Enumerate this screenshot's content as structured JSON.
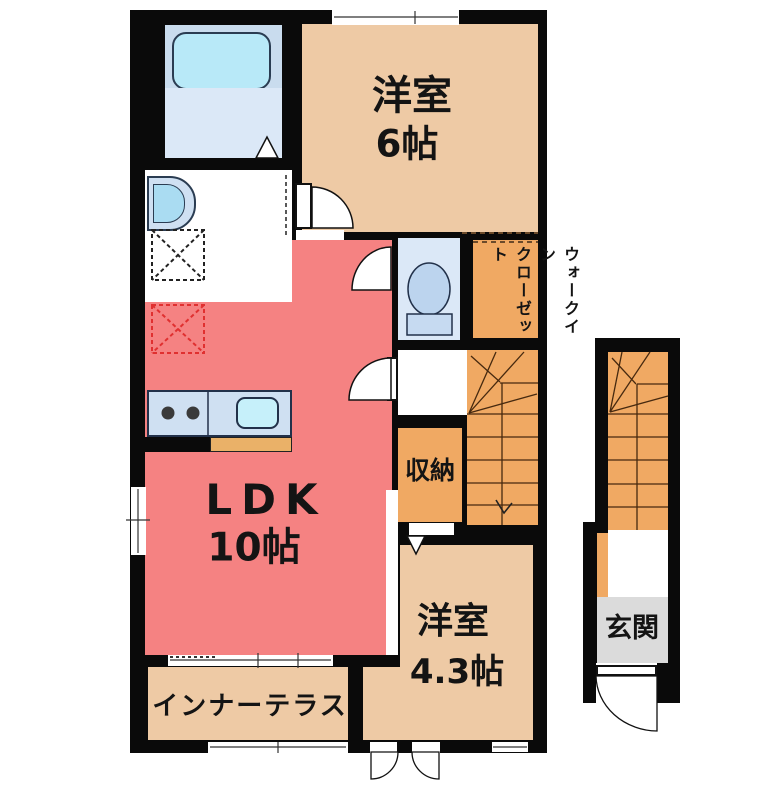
{
  "plan_title": "apartment-floor-plan",
  "rooms": {
    "western_room_6": {
      "name": "洋室",
      "size": "6帖"
    },
    "ldk": {
      "name": "LDK",
      "size": "10帖"
    },
    "western_room_43": {
      "name": "洋室",
      "size": "4.3帖"
    },
    "walk_in_closet": {
      "line1": "ウォークイン",
      "line2": "クローゼット"
    },
    "storage": {
      "name": "収納"
    },
    "inner_terrace": {
      "name": "インナーテラス"
    },
    "entrance": {
      "name": "玄関"
    }
  },
  "colors": {
    "wall": "#0a0a0a",
    "room_tan": "#eecaa5",
    "ldk_pink": "#f58282",
    "stairs_orange": "#f0a963",
    "wet_room_blue": "#dbe8f7",
    "fixture_blue": "#b8e9f8",
    "counter_blue": "#cfe0f2",
    "entrance_gray": "#dbdbdb",
    "kitchen_strip": "#eab168",
    "fridge_dashed": "#e03030"
  }
}
